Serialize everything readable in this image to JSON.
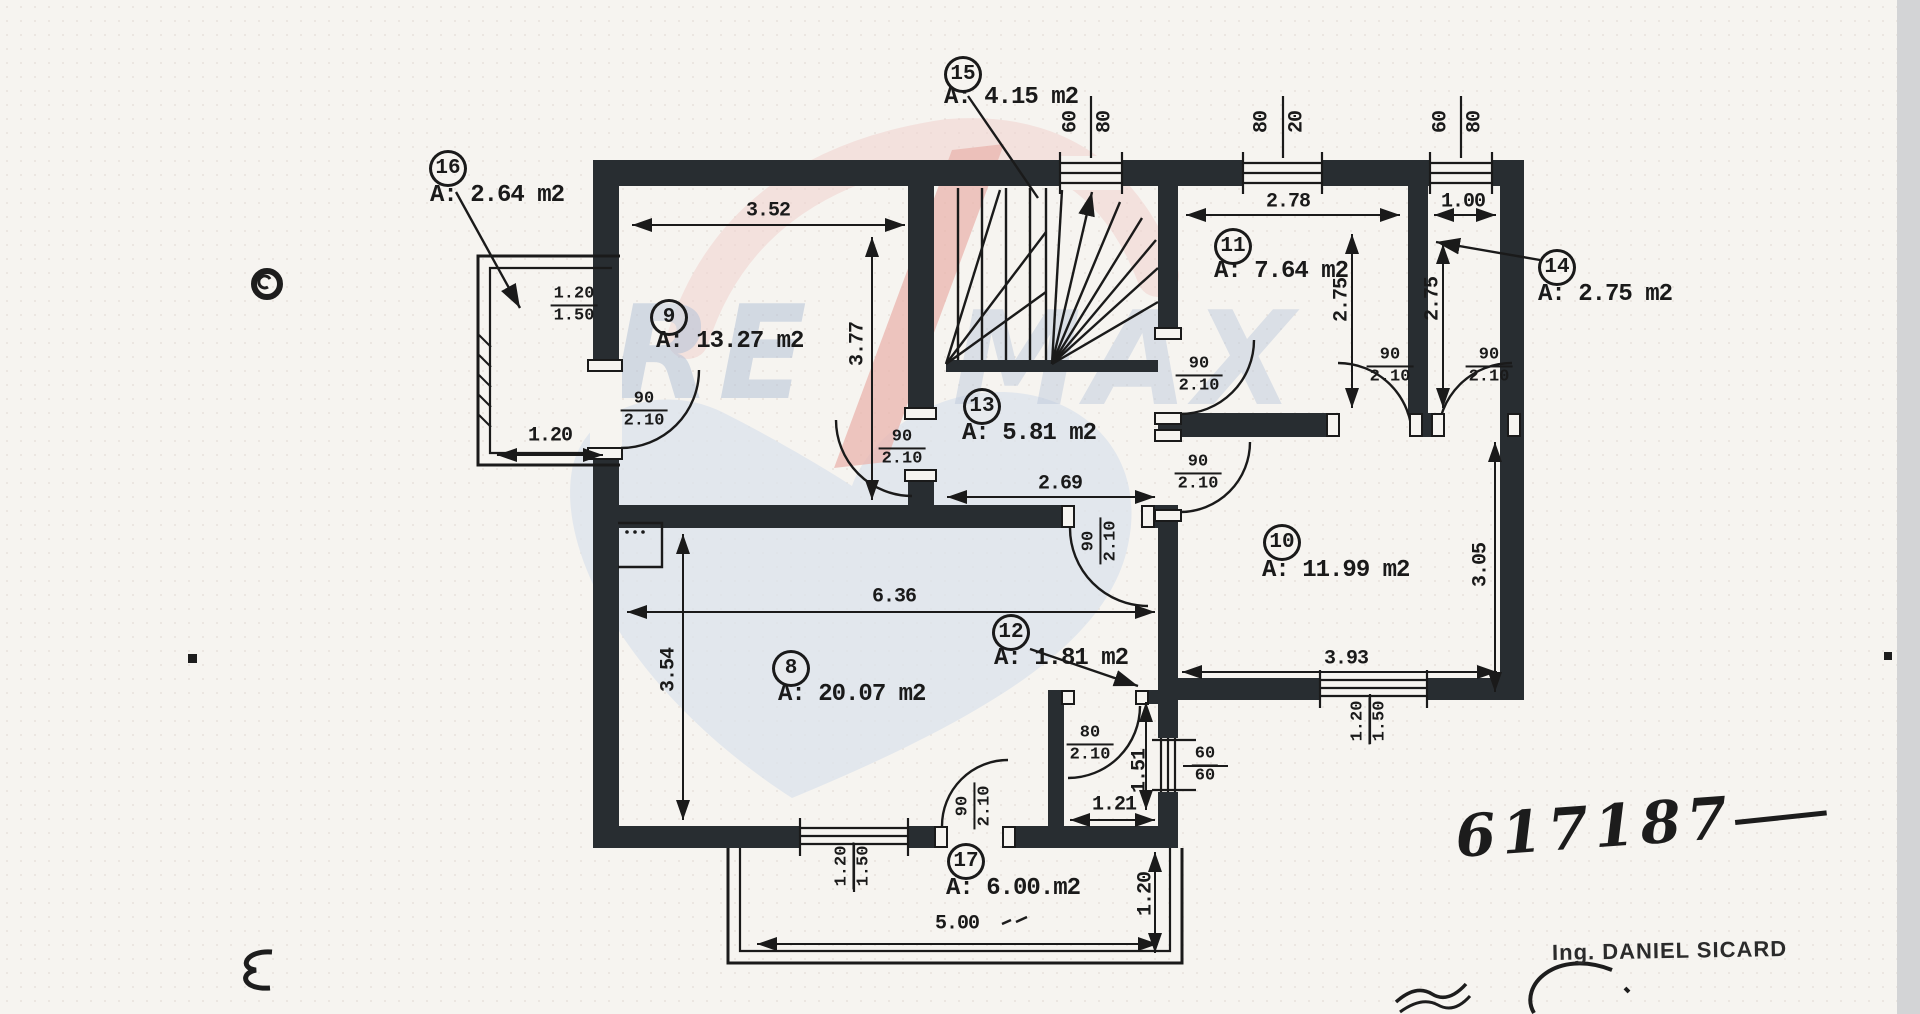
{
  "watermark": {
    "re": "RE",
    "max": "MAX"
  },
  "plan_number": "617187",
  "engineer": "Ing. DANIEL SICARD",
  "rooms": [
    {
      "id": "15",
      "area": "A: 4.15 m2",
      "cx": 963,
      "cy": 74,
      "tx": 944,
      "ty": 84
    },
    {
      "id": "16",
      "area": "A: 2.64 m2",
      "cx": 448,
      "cy": 168,
      "tx": 430,
      "ty": 182
    },
    {
      "id": "9",
      "area": "A: 13.27 m2",
      "cx": 669,
      "cy": 317,
      "tx": 656,
      "ty": 328
    },
    {
      "id": "13",
      "area": "A: 5.81 m2",
      "cx": 982,
      "cy": 406,
      "tx": 962,
      "ty": 420
    },
    {
      "id": "11",
      "area": "A: 7.64 m2",
      "cx": 1233,
      "cy": 246,
      "tx": 1214,
      "ty": 258
    },
    {
      "id": "14",
      "area": "A: 2.75 m2",
      "cx": 1557,
      "cy": 267,
      "tx": 1538,
      "ty": 281
    },
    {
      "id": "10",
      "area": "A: 11.99 m2",
      "cx": 1282,
      "cy": 542,
      "tx": 1262,
      "ty": 557
    },
    {
      "id": "12",
      "area": "A: 1.81 m2",
      "cx": 1011,
      "cy": 632,
      "tx": 994,
      "ty": 645
    },
    {
      "id": "8",
      "area": "A: 20.07 m2",
      "cx": 791,
      "cy": 668,
      "tx": 778,
      "ty": 681
    },
    {
      "id": "17",
      "area": "A: 6.00.m2",
      "cx": 966,
      "cy": 861,
      "tx": 946,
      "ty": 875
    }
  ],
  "dims": [
    {
      "t": "3.52",
      "x": 768,
      "y": 211,
      "r": 0
    },
    {
      "t": "2.78",
      "x": 1288,
      "y": 202,
      "r": 0
    },
    {
      "t": "1.00",
      "x": 1463,
      "y": 202,
      "r": 0
    },
    {
      "t": "2.69",
      "x": 1060,
      "y": 484,
      "r": 0
    },
    {
      "t": "6.36",
      "x": 894,
      "y": 597,
      "r": 0
    },
    {
      "t": "3.93",
      "x": 1346,
      "y": 659,
      "r": 0
    },
    {
      "t": "1.21",
      "x": 1114,
      "y": 805,
      "r": 0
    },
    {
      "t": "5.00",
      "x": 957,
      "y": 924,
      "r": 0
    },
    {
      "t": "1.20",
      "x": 550,
      "y": 436,
      "r": 0
    },
    {
      "t": "3.77",
      "x": 858,
      "y": 344,
      "r": -90
    },
    {
      "t": "2.75",
      "x": 1342,
      "y": 300,
      "r": -90
    },
    {
      "t": "2.75",
      "x": 1433,
      "y": 299,
      "r": -90
    },
    {
      "t": "3.54",
      "x": 669,
      "y": 670,
      "r": -90
    },
    {
      "t": "3.05",
      "x": 1481,
      "y": 565,
      "r": -90
    },
    {
      "t": "1.51",
      "x": 1140,
      "y": 771,
      "r": -90
    },
    {
      "t": "1.20",
      "x": 1146,
      "y": 894,
      "r": -90
    },
    {
      "t": "60",
      "x": 1071,
      "y": 122,
      "r": -90
    },
    {
      "t": "80",
      "x": 1105,
      "y": 122,
      "r": -90
    },
    {
      "t": "80",
      "x": 1262,
      "y": 122,
      "r": -90
    },
    {
      "t": "20",
      "x": 1297,
      "y": 122,
      "r": -90
    },
    {
      "t": "60",
      "x": 1441,
      "y": 122,
      "r": -90
    },
    {
      "t": "80",
      "x": 1475,
      "y": 122,
      "r": -90
    }
  ],
  "door_labels": [
    {
      "a": "90",
      "b": "2.10",
      "x": 644,
      "y": 410,
      "r": 0
    },
    {
      "a": "90",
      "b": "2.10",
      "x": 902,
      "y": 448,
      "r": 0
    },
    {
      "a": "90",
      "b": "2.10",
      "x": 1199,
      "y": 375,
      "r": 0
    },
    {
      "a": "90",
      "b": "2.10",
      "x": 1198,
      "y": 473,
      "r": 0
    },
    {
      "a": "90",
      "b": "2.10",
      "x": 1390,
      "y": 366,
      "r": 0
    },
    {
      "a": "90",
      "b": "2.10",
      "x": 1489,
      "y": 366,
      "r": 0
    },
    {
      "a": "80",
      "b": "2.10",
      "x": 1090,
      "y": 744,
      "r": 0
    },
    {
      "a": "90",
      "b": "2.10",
      "x": 1100,
      "y": 541,
      "r": -90
    },
    {
      "a": "90",
      "b": "2.10",
      "x": 974,
      "y": 806,
      "r": -90
    },
    {
      "a": "60",
      "b": "60",
      "x": 1205,
      "y": 765,
      "r": 0
    },
    {
      "a": "1.20",
      "b": "1.50",
      "x": 574,
      "y": 305,
      "r": 0
    },
    {
      "a": "1.20",
      "b": "1.50",
      "x": 853,
      "y": 866,
      "r": -90
    },
    {
      "a": "1.20",
      "b": "1.50",
      "x": 1369,
      "y": 721,
      "r": -90
    }
  ]
}
